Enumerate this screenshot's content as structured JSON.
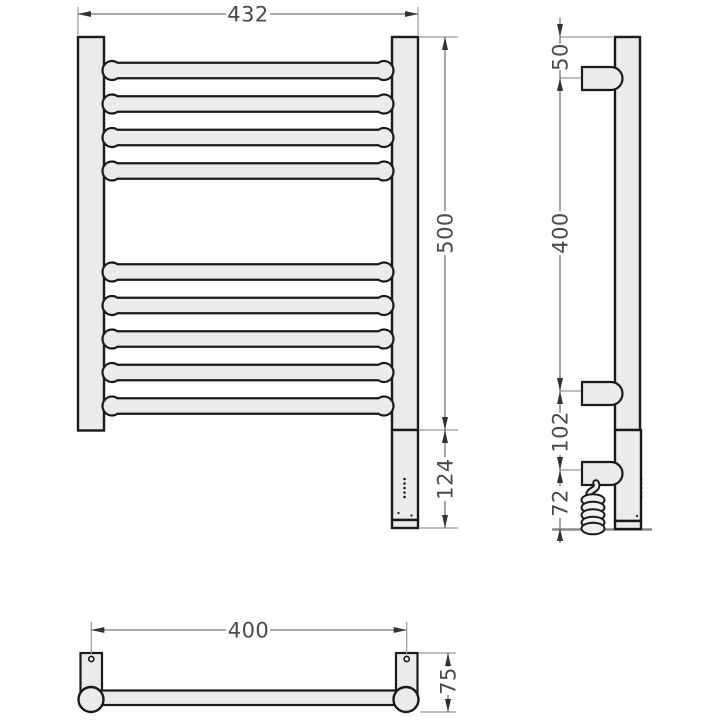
{
  "drawing": {
    "type": "technical-drawing",
    "subject": "electric heated towel rail - three orthographic views with dimensions",
    "units": "mm",
    "colors": {
      "object_line": "#1a1a1a",
      "metal_fill": "#ebebeb",
      "dimension_line": "#777777",
      "dimension_text": "#4a4a4a",
      "ground_line": "#8a8a8a",
      "background": "#ffffff"
    },
    "views": {
      "front": {
        "label": "front view",
        "bar_count": 9,
        "dimensions": {
          "overall_width": {
            "value": "432"
          },
          "overall_height": {
            "value": "500"
          },
          "heating_element_height": {
            "value": "124"
          }
        }
      },
      "side": {
        "label": "side view",
        "dimensions": {
          "top_to_upper_bracket": {
            "value": "50"
          },
          "bracket_spacing": {
            "value": "400"
          },
          "lower_bracket_to_cable_outlet": {
            "value": "102"
          },
          "cable_outlet_to_floor": {
            "value": "72"
          }
        }
      },
      "bottom": {
        "label": "bottom view",
        "dimensions": {
          "mounting_centers": {
            "value": "400"
          },
          "wall_depth": {
            "value": "75"
          }
        }
      }
    }
  }
}
